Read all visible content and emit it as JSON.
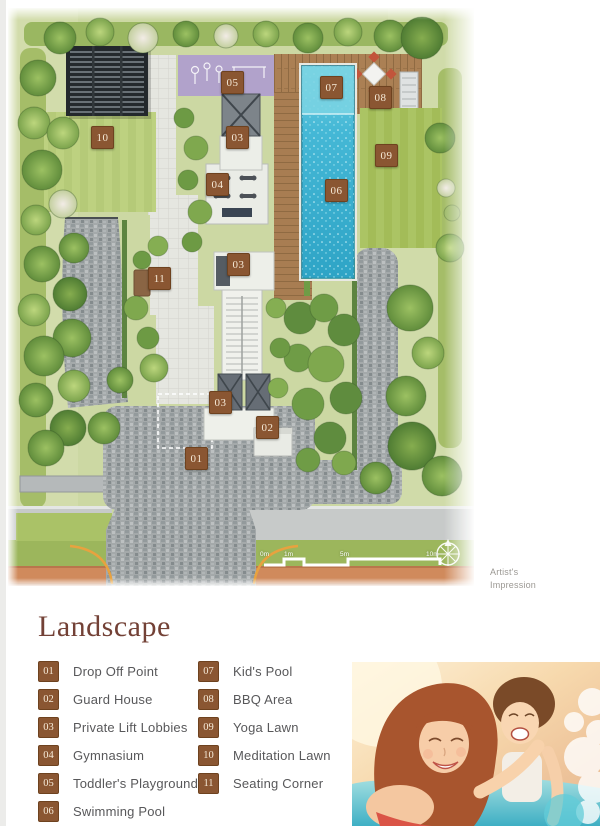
{
  "plan": {
    "caption": "Artist's Impression",
    "scale_bar": {
      "labels": [
        "0m",
        "1m",
        "5m",
        "10m"
      ]
    },
    "markers": [
      {
        "num": "05",
        "x": 213,
        "y": 63
      },
      {
        "num": "07",
        "x": 312,
        "y": 68
      },
      {
        "num": "08",
        "x": 361,
        "y": 78
      },
      {
        "num": "03",
        "x": 218,
        "y": 118
      },
      {
        "num": "10",
        "x": 83,
        "y": 118
      },
      {
        "num": "09",
        "x": 367,
        "y": 136
      },
      {
        "num": "04",
        "x": 198,
        "y": 165
      },
      {
        "num": "06",
        "x": 317,
        "y": 171
      },
      {
        "num": "03",
        "x": 219,
        "y": 245
      },
      {
        "num": "11",
        "x": 140,
        "y": 259
      },
      {
        "num": "03",
        "x": 201,
        "y": 383
      },
      {
        "num": "02",
        "x": 248,
        "y": 408
      },
      {
        "num": "01",
        "x": 177,
        "y": 439
      }
    ]
  },
  "legend": {
    "title": "Landscape",
    "columns": [
      {
        "items": [
          {
            "num": "01",
            "label": "Drop Off Point"
          },
          {
            "num": "02",
            "label": "Guard House"
          },
          {
            "num": "03",
            "label": "Private Lift Lobbies"
          },
          {
            "num": "04",
            "label": "Gymnasium"
          },
          {
            "num": "05",
            "label": "Toddler's Playground"
          },
          {
            "num": "06",
            "label": "Swimming Pool"
          }
        ]
      },
      {
        "items": [
          {
            "num": "07",
            "label": "Kid's Pool"
          },
          {
            "num": "08",
            "label": "BBQ Area"
          },
          {
            "num": "09",
            "label": "Yoga Lawn"
          },
          {
            "num": "10",
            "label": "Meditation Lawn"
          },
          {
            "num": "11",
            "label": "Seating Corner"
          }
        ]
      }
    ]
  },
  "colors": {
    "marker_brown": "#8a5632",
    "title_brown": "#734136",
    "label_gray": "#58585a",
    "pool_blue": "#45b8d6",
    "lawn_green": "#a3bc5b",
    "road_orange": "#d08a5c",
    "cobble_gray": "#a3a8a9",
    "playground_purple": "#b1a2cb",
    "deck_wood": "#ab8054"
  }
}
